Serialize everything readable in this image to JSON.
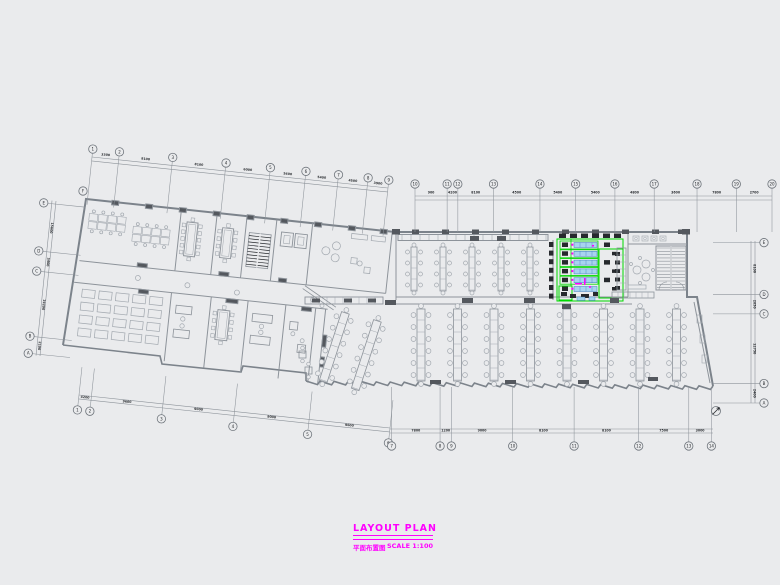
{
  "colors": {
    "background": "#eaebed",
    "line": "#8d939a",
    "line_light": "#a2a8af",
    "wall": "#7c838b",
    "dark": "#54585e",
    "black": "#26292d",
    "dim_text": "#2c2f33",
    "highlight_green": "#00d900",
    "equip_fill": "#a8d3ef",
    "equip_edge": "#3f7fbe",
    "magenta": "#ff00ff"
  },
  "title_block": {
    "title": "LAYOUT PLAN",
    "subtitle_cn": "平面布置图",
    "scale_label": "SCALE 1:100"
  },
  "grid_rows": {
    "top_left": {
      "labels": [
        "1",
        "2",
        "3",
        "4",
        "5",
        "6",
        "7",
        "8",
        "9"
      ],
      "dims": [
        "3300",
        "8100",
        "8100",
        "6000",
        "5400",
        "5400",
        "4500",
        "3900"
      ]
    },
    "top_right": {
      "labels": [
        "10",
        "11",
        "12",
        "13",
        "14",
        "15",
        "16",
        "17",
        "18",
        "19",
        "20"
      ],
      "dims": [
        "900",
        "4200",
        "8100",
        "4500",
        "5400",
        "5400",
        "4800",
        "3600",
        "7800",
        "2700"
      ]
    },
    "left": {
      "labels": [
        "E",
        "D",
        "C",
        "B",
        "A"
      ],
      "corner_label": "F",
      "dims": [
        "15600",
        "5400",
        "19200",
        "2100"
      ]
    },
    "right": {
      "labels": [
        "E",
        "D",
        "C",
        "B",
        "A"
      ],
      "dims": [
        "8100",
        "2850",
        "12750",
        "2400"
      ]
    },
    "bottom_left": {
      "labels": [
        "1",
        "2",
        "3",
        "4",
        "5",
        "6"
      ],
      "dims": [
        "4200",
        "9600",
        "9000",
        "9000",
        "9600"
      ]
    },
    "bottom_right": {
      "labels": [
        "7",
        "8",
        "9",
        "10",
        "11",
        "12",
        "13",
        "14"
      ],
      "dims": [
        "7800",
        "1200",
        "9000",
        "8100",
        "8100",
        "7500",
        "3000"
      ]
    }
  },
  "plan": {
    "dining_lower_columns": 8,
    "dining_upper_columns": 5,
    "dining_tilted_columns": 2,
    "kitchen_equipment_rows": 6,
    "canteen_grid": {
      "rows": 4,
      "cols": 5
    },
    "highlight_zone": "kitchen-equipment"
  }
}
